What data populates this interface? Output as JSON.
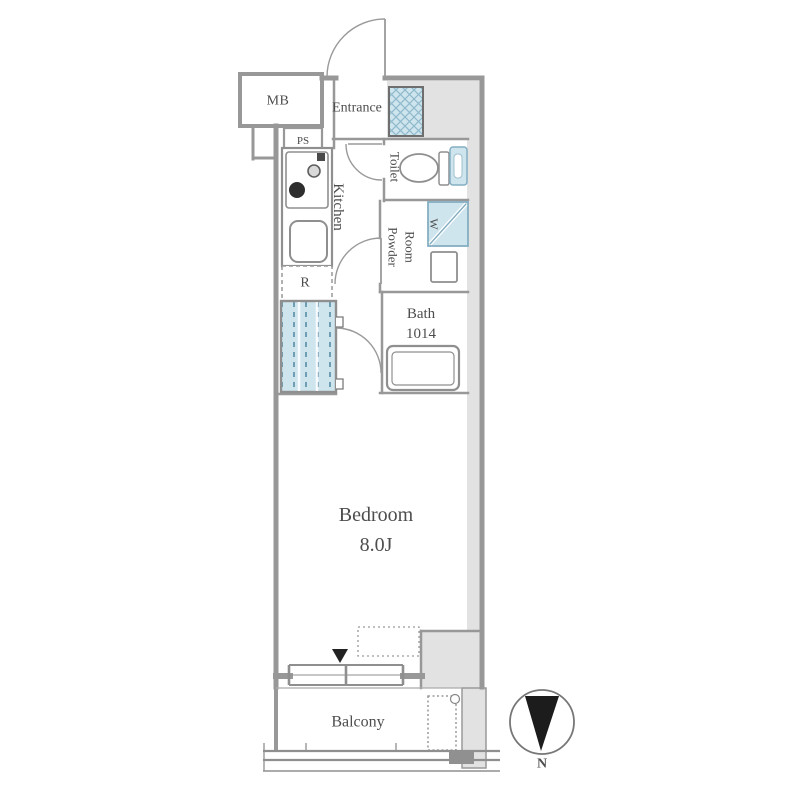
{
  "floorplan": {
    "rooms": {
      "mb": "MB",
      "ps": "PS",
      "entrance": "Entrance",
      "kitchen": "Kitchen",
      "toilet": "Toilet",
      "powder_room": {
        "line1": "Powder",
        "line2": "Room"
      },
      "bath": {
        "line1": "Bath",
        "line2": "1014"
      },
      "bedroom": {
        "name": "Bedroom",
        "size": "8.0J"
      },
      "balcony": "Balcony"
    },
    "fixtures": {
      "washer": "W",
      "refrigerator": "R"
    },
    "compass": {
      "north": "N"
    },
    "colors": {
      "wall": "#989898",
      "shade": "#e2e2e2",
      "fixture_blue": "#cfe5ee",
      "fixture_blue_stroke": "#84aec2",
      "text": "#4d4d4d",
      "compass_fill": "#1c1c1c"
    }
  }
}
